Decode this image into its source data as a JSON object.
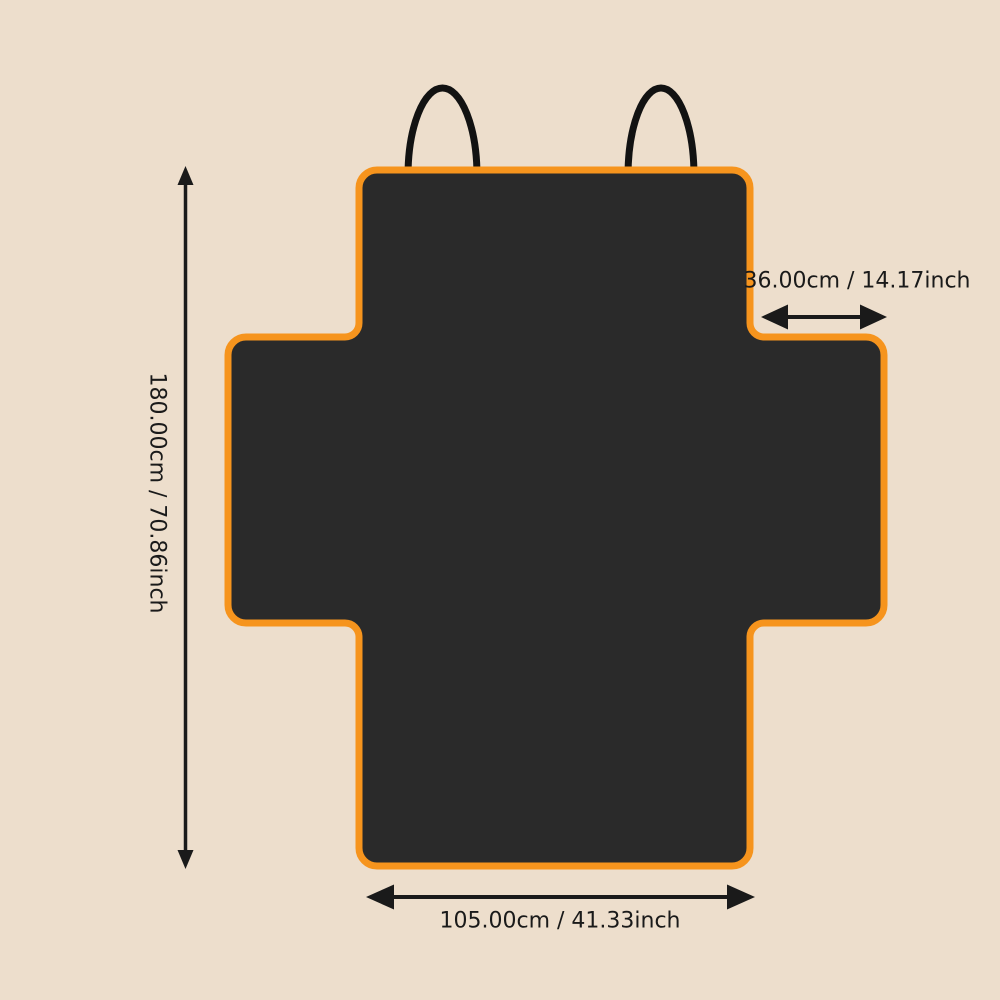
{
  "colors": {
    "background": "#EDDECC",
    "cover_fill": "#2A2A2A",
    "cover_border": "#F6941D",
    "strap": "#121212",
    "dimension_line": "#1A1A1A"
  },
  "diagram": {
    "height_label": "180.00cm / 70.86inch",
    "flap_width_label": "36.00cm / 14.17inch",
    "base_width_label": "105.00cm / 41.33inch"
  }
}
